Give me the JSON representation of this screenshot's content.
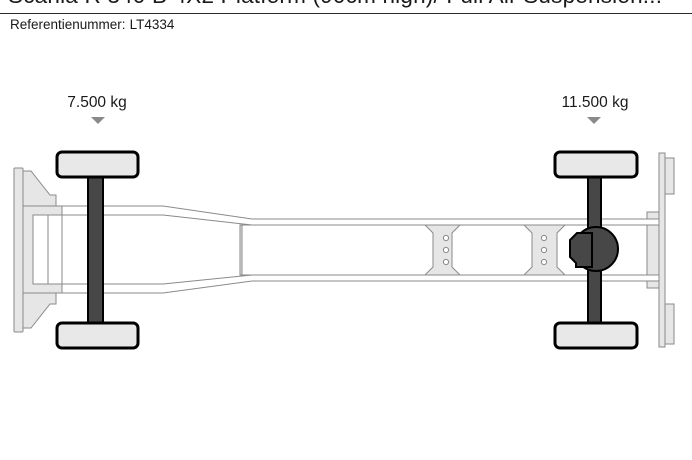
{
  "header": {
    "title": "Scania R 340 B 4X2 Platform (90cm high)/ Full Air Suspension...",
    "reference_label": "Referentienummer:",
    "reference_value": "LT4334"
  },
  "diagram": {
    "view": "truck chassis top view",
    "front_axle": {
      "load": "7.500 kg"
    },
    "rear_axle": {
      "load": "11.500 kg"
    },
    "icons": {
      "axle_load_marker": "triangle-down"
    }
  },
  "colors": {
    "text": "#1a1a1a",
    "separator": "#2b2b2b",
    "outline_gray": "#8a8a8a",
    "light_fill": "#e6e6e6",
    "panel_white": "#ffffff",
    "chassis_dark": "#474747",
    "stroke_black": "#000000",
    "arrow_gray": "#8a8a8a",
    "background": "#ffffff"
  }
}
